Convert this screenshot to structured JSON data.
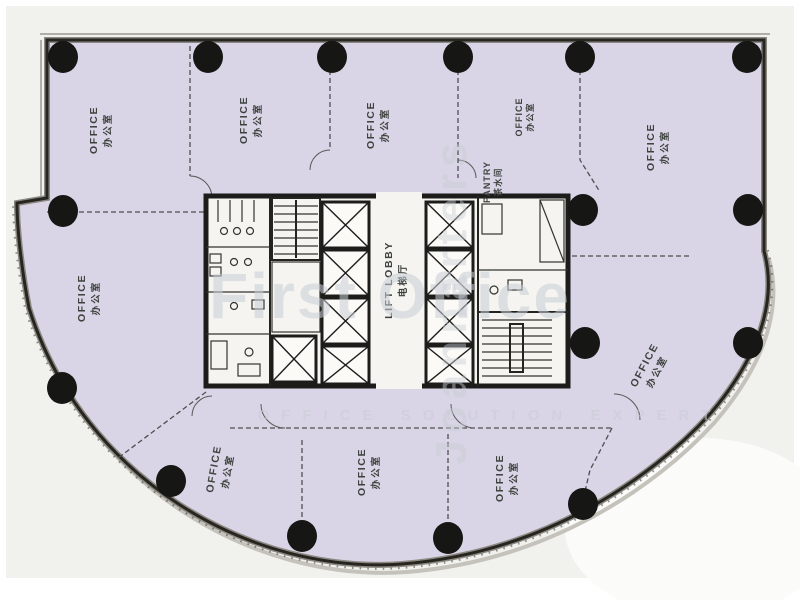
{
  "labels": {
    "offices": [
      {
        "en": "OFFICE",
        "zh": "办公室"
      },
      {
        "en": "OFFICE",
        "zh": "办公室"
      },
      {
        "en": "OFFICE",
        "zh": "办公室"
      },
      {
        "en": "OFFICE",
        "zh": "办公室"
      },
      {
        "en": "OFFICE",
        "zh": "办公室"
      },
      {
        "en": "OFFICE",
        "zh": "办公室"
      },
      {
        "en": "OFFICE",
        "zh": "办公室"
      },
      {
        "en": "OFFICE",
        "zh": "办公室"
      },
      {
        "en": "OFFICE",
        "zh": "办公室"
      },
      {
        "en": "OFFICE",
        "zh": "办公室"
      }
    ],
    "pantry": {
      "en": "PANTRY",
      "zh": "茶水间"
    },
    "lift_lobby": {
      "en": "LIFT LOBBY",
      "zh": "电梯厅"
    }
  },
  "watermarks": {
    "brand": "First Office",
    "tagline": "OFFICE SOLUTION EXPERT",
    "vertical": "Joannarters"
  },
  "colors": {
    "floor": "#d9d4e6",
    "outside": "#f1f1ee",
    "wall": "#23231f",
    "column": "#161614",
    "core_fill": "#f5f4f0",
    "label": "#3d423d",
    "watermark": "#c9ced6"
  }
}
